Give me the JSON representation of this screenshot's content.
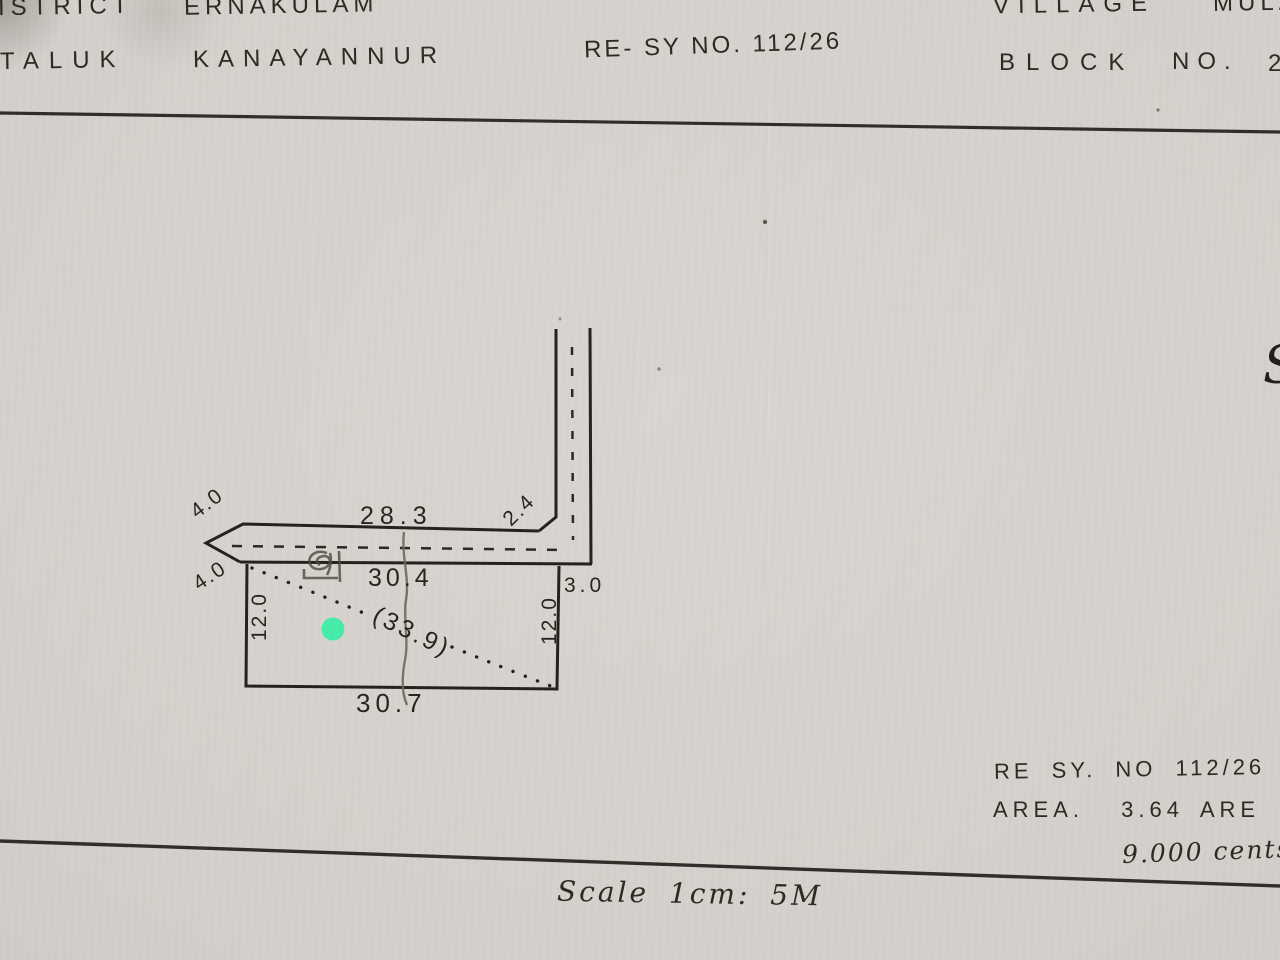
{
  "header": {
    "district_label": "ISTRICT",
    "district_value": "ERNAKULAM",
    "taluk_label": "TALUK",
    "taluk_value": "KANAYANNUR",
    "resurvey_no": "RE- SY NO. 112/26",
    "village_label": "VILLAGE",
    "village_value": "MULAN",
    "block_label": "BLOCK",
    "block_no_label": "NO.",
    "block_no_value": "2"
  },
  "sketch": {
    "dimensions": {
      "top_road_length": "28.3",
      "arrow_upper": "4.0",
      "arrow_lower": "4.0",
      "corner": "2.4",
      "east_width": "3.0",
      "plot_top": "30.4",
      "plot_left": "12.0",
      "plot_right": "12.0",
      "plot_bottom": "30.7",
      "diagonal": "(33.9)"
    }
  },
  "footer": {
    "resurvey_line": "RE SY. NO 112/26",
    "resurvey_suffix": "Pt",
    "area_label": "AREA.",
    "area_value": "3.64 ARE",
    "cents_value": "9.000 cents",
    "scale_text": "Scale 1cm: 5M"
  },
  "stray": {
    "right_margin_partial_glyph": "S"
  },
  "colors": {
    "paper": "#d3d0cb",
    "ink": "#26231d",
    "pencil": "#6e665a",
    "marker": "#3deca6"
  }
}
